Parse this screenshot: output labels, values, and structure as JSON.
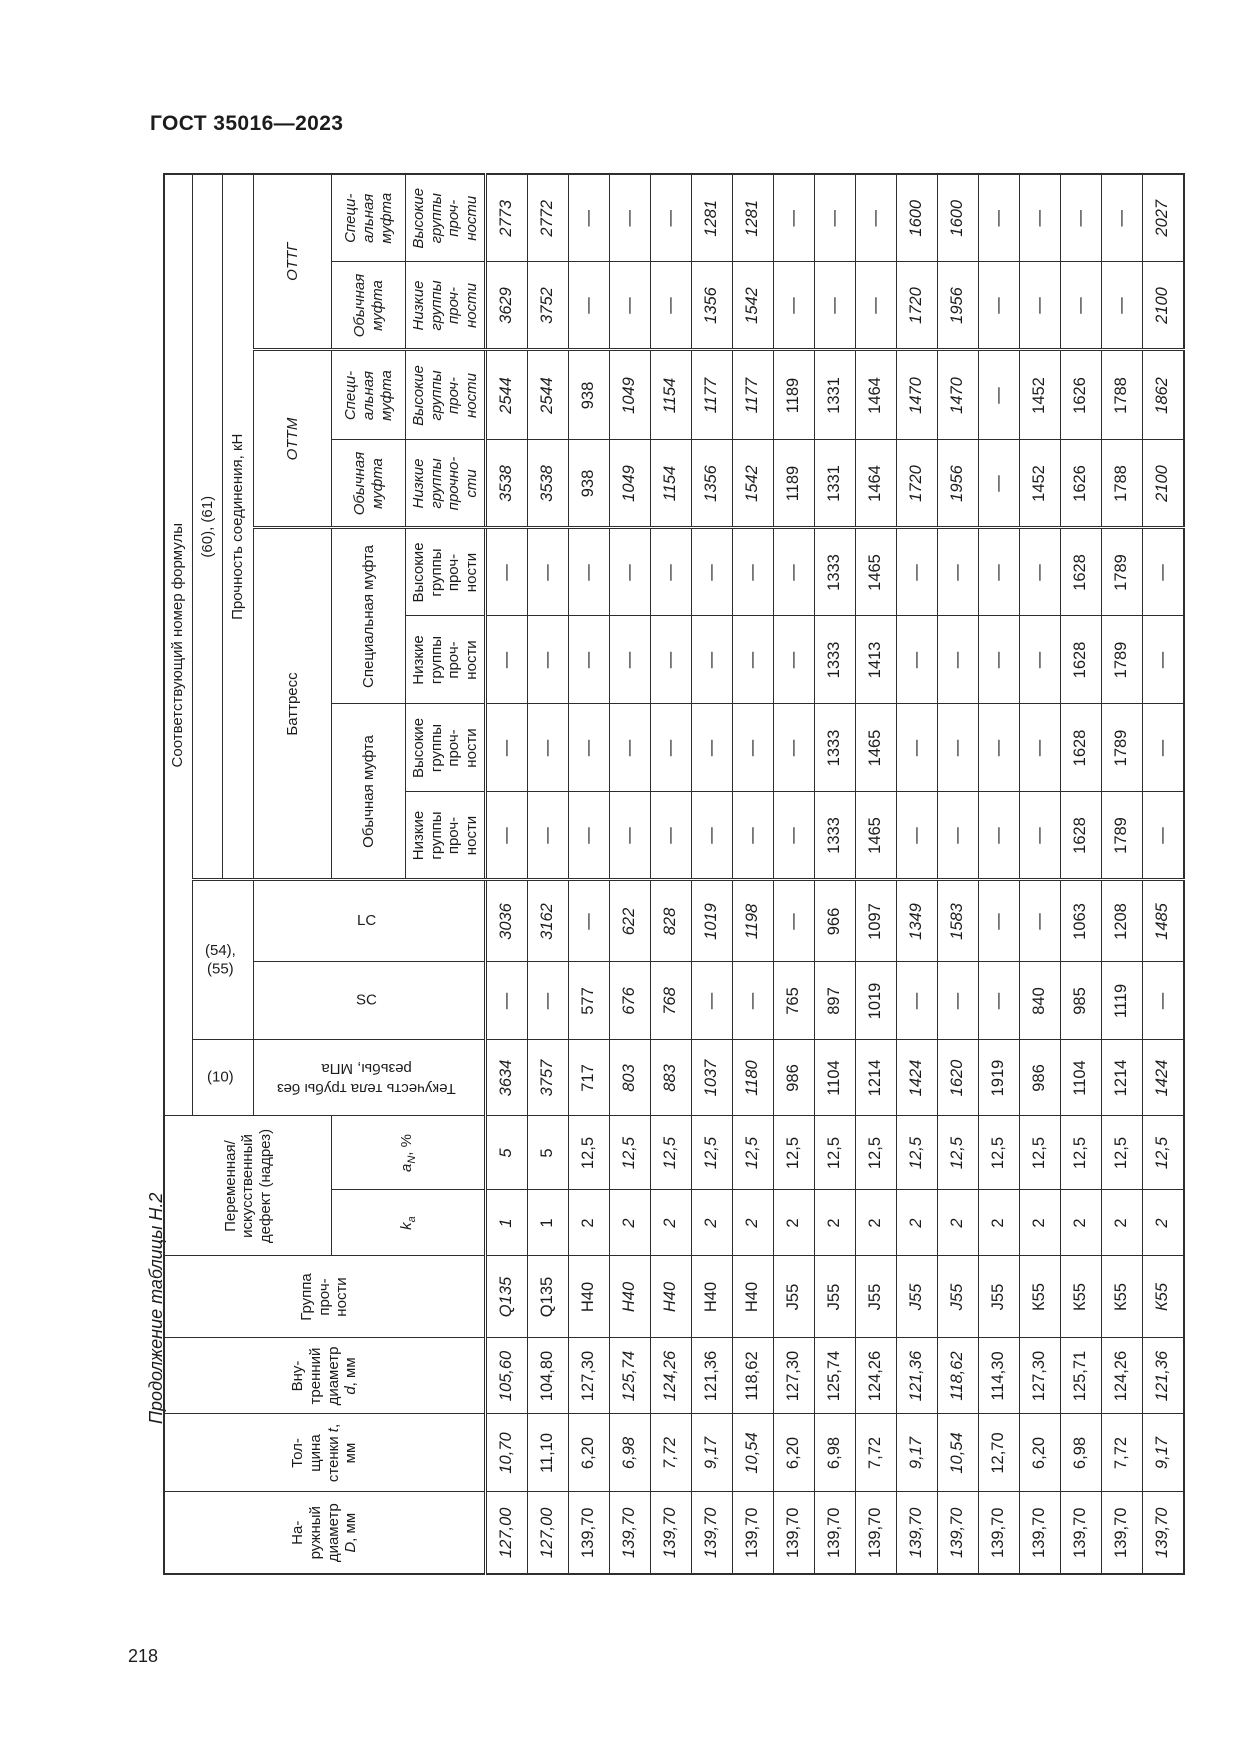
{
  "page": {
    "doc_header": "ГОСТ 35016—2023",
    "table_caption": "Продолжение таблицы Н.2",
    "page_number": "218"
  },
  "table": {
    "corr_formula": "Соответствующий номер формулы",
    "formula_yield": "(10)",
    "formula_sclc": "(54), (55)",
    "formula_conn": "(60), (61)",
    "conn_strength": "Прочность соединения, кН",
    "cols": {
      "outer_pre": "На-\nружный\nдиаметр\n",
      "outer_sym": "D",
      "outer_post": ", мм",
      "wall_pre": "Тол-\nщина\nстенки ",
      "wall_sym": "t",
      "wall_post": ",\nмм",
      "inner_pre": "Вну-\nтренний\nдиаметр\n",
      "inner_sym": "d",
      "inner_post": ", мм",
      "grade": "Группа\nпроч-\nности",
      "defect": "Переменная/\nискусственный\nдефект (надрез)",
      "ka_sym": "k",
      "ka_sub": "a",
      "an_sym": "a",
      "an_sub": "N",
      "an_post": ", %",
      "yield_body": "Текучесть тела трубы без\nрезьбы, МПа",
      "sc": "SC",
      "lc": "LC"
    },
    "groups": {
      "buttress": "Баттресс",
      "ottm": "ОТТМ",
      "ottg": "ОТТГ",
      "regular_coupling": "Обычная муфта",
      "special_coupling": "Специальная муфта",
      "regular_coupling_narrow": "Обычная\nмуфта",
      "special_coupling_narrow": "Специ-\nальная\nмуфта",
      "low_groups": "Низкие\nгруппы\nпроч-\nности",
      "high_groups": "Высокие\nгруппы\nпроч-\nности",
      "low_groups_ottm": "Низкие\nгруппы\nпрочно-\nсти"
    },
    "rows": [
      {
        "v": [
          "127,00",
          "10,70",
          "105,60",
          "Q135",
          "1",
          "5",
          "3634",
          "—",
          "3036",
          "—",
          "—",
          "—",
          "—",
          "3538",
          "2544",
          "3629",
          "2773"
        ],
        "s": [
          "i",
          "i",
          "i",
          "i",
          "i",
          "bi",
          "bi",
          "n",
          "bi",
          "n",
          "n",
          "n",
          "n",
          "i",
          "i",
          "i",
          "i"
        ]
      },
      {
        "v": [
          "127,00",
          "11,10",
          "104,80",
          "Q135",
          "1",
          "5",
          "3757",
          "—",
          "3162",
          "—",
          "—",
          "—",
          "—",
          "3538",
          "2544",
          "3752",
          "2772"
        ],
        "s": [
          "i",
          "n",
          "n",
          "n",
          "n",
          "n",
          "i",
          "n",
          "i",
          "n",
          "n",
          "n",
          "n",
          "i",
          "i",
          "i",
          "i"
        ]
      },
      {
        "v": [
          "139,70",
          "6,20",
          "127,30",
          "Н40",
          "2",
          "12,5",
          "717",
          "577",
          "—",
          "—",
          "—",
          "—",
          "—",
          "938",
          "938",
          "—",
          "—"
        ],
        "s": [
          "n",
          "n",
          "n",
          "n",
          "n",
          "n",
          "n",
          "n",
          "n",
          "n",
          "n",
          "n",
          "n",
          "n",
          "n",
          "n",
          "n"
        ]
      },
      {
        "v": [
          "139,70",
          "6,98",
          "125,74",
          "Н40",
          "2",
          "12,5",
          "803",
          "676",
          "622",
          "—",
          "—",
          "—",
          "—",
          "1049",
          "1049",
          "—",
          "—"
        ],
        "s": [
          "i",
          "i",
          "i",
          "i",
          "i",
          "i",
          "i",
          "bi",
          "i",
          "n",
          "n",
          "n",
          "n",
          "i",
          "i",
          "n",
          "n"
        ]
      },
      {
        "v": [
          "139,70",
          "7,72",
          "124,26",
          "Н40",
          "2",
          "12,5",
          "883",
          "768",
          "828",
          "—",
          "—",
          "—",
          "—",
          "1154",
          "1154",
          "—",
          "—"
        ],
        "s": [
          "i",
          "i",
          "i",
          "i",
          "i",
          "i",
          "i",
          "bi",
          "i",
          "n",
          "n",
          "n",
          "n",
          "i",
          "i",
          "n",
          "n"
        ]
      },
      {
        "v": [
          "139,70",
          "9,17",
          "121,36",
          "Н40",
          "2",
          "12,5",
          "1037",
          "—",
          "1019",
          "—",
          "—",
          "—",
          "—",
          "1356",
          "1177",
          "1356",
          "1281"
        ],
        "s": [
          "i",
          "i",
          "n",
          "n",
          "i",
          "i",
          "i",
          "n",
          "i",
          "n",
          "n",
          "n",
          "n",
          "i",
          "i",
          "i",
          "i"
        ]
      },
      {
        "v": [
          "139,70",
          "10,54",
          "118,62",
          "Н40",
          "2",
          "12,5",
          "1180",
          "—",
          "1198",
          "—",
          "—",
          "—",
          "—",
          "1542",
          "1177",
          "1542",
          "1281"
        ],
        "s": [
          "n",
          "i",
          "n",
          "n",
          "i",
          "i",
          "i",
          "n",
          "i",
          "n",
          "n",
          "n",
          "n",
          "i",
          "i",
          "i",
          "i"
        ]
      },
      {
        "v": [
          "139,70",
          "6,20",
          "127,30",
          "J55",
          "2",
          "12,5",
          "986",
          "765",
          "—",
          "—",
          "—",
          "—",
          "—",
          "1189",
          "1189",
          "—",
          "—"
        ],
        "s": [
          "n",
          "n",
          "n",
          "n",
          "n",
          "n",
          "n",
          "n",
          "n",
          "n",
          "n",
          "n",
          "n",
          "n",
          "n",
          "n",
          "n"
        ]
      },
      {
        "v": [
          "139,70",
          "6,98",
          "125,74",
          "J55",
          "2",
          "12,5",
          "1104",
          "897",
          "966",
          "1333",
          "1333",
          "1333",
          "1333",
          "1331",
          "1331",
          "—",
          "—"
        ],
        "s": [
          "n",
          "n",
          "n",
          "n",
          "n",
          "n",
          "n",
          "n",
          "n",
          "n",
          "n",
          "n",
          "n",
          "n",
          "n",
          "n",
          "n"
        ]
      },
      {
        "v": [
          "139,70",
          "7,72",
          "124,26",
          "J55",
          "2",
          "12,5",
          "1214",
          "1019",
          "1097",
          "1465",
          "1465",
          "1413",
          "1465",
          "1464",
          "1464",
          "—",
          "—"
        ],
        "s": [
          "n",
          "n",
          "n",
          "n",
          "n",
          "n",
          "n",
          "n",
          "n",
          "n",
          "n",
          "n",
          "n",
          "n",
          "n",
          "n",
          "n"
        ]
      },
      {
        "v": [
          "139,70",
          "9,17",
          "121,36",
          "J55",
          "2",
          "12,5",
          "1424",
          "—",
          "1349",
          "—",
          "—",
          "—",
          "—",
          "1720",
          "1470",
          "1720",
          "1600"
        ],
        "s": [
          "i",
          "i",
          "i",
          "i",
          "i",
          "i",
          "i",
          "n",
          "i",
          "n",
          "n",
          "n",
          "n",
          "i",
          "i",
          "i",
          "i"
        ]
      },
      {
        "v": [
          "139,70",
          "10,54",
          "118,62",
          "J55",
          "2",
          "12,5",
          "1620",
          "—",
          "1583",
          "—",
          "—",
          "—",
          "—",
          "1956",
          "1470",
          "1956",
          "1600"
        ],
        "s": [
          "i",
          "i",
          "i",
          "i",
          "i",
          "i",
          "i",
          "n",
          "i",
          "n",
          "n",
          "n",
          "n",
          "i",
          "i",
          "i",
          "i"
        ]
      },
      {
        "v": [
          "139,70",
          "12,70",
          "114,30",
          "J55",
          "2",
          "12,5",
          "1919",
          "—",
          "—",
          "—",
          "—",
          "—",
          "—",
          "—",
          "—",
          "—",
          "—"
        ],
        "s": [
          "n",
          "n",
          "n",
          "n",
          "n",
          "n",
          "n",
          "n",
          "n",
          "n",
          "n",
          "n",
          "n",
          "n",
          "n",
          "n",
          "n"
        ]
      },
      {
        "v": [
          "139,70",
          "6,20",
          "127,30",
          "К55",
          "2",
          "12,5",
          "986",
          "840",
          "—",
          "—",
          "—",
          "—",
          "—",
          "1452",
          "1452",
          "—",
          "—"
        ],
        "s": [
          "n",
          "n",
          "n",
          "n",
          "n",
          "n",
          "n",
          "n",
          "n",
          "n",
          "n",
          "n",
          "n",
          "n",
          "n",
          "n",
          "n"
        ]
      },
      {
        "v": [
          "139,70",
          "6,98",
          "125,71",
          "К55",
          "2",
          "12,5",
          "1104",
          "985",
          "1063",
          "1628",
          "1628",
          "1628",
          "1628",
          "1626",
          "1626",
          "—",
          "—"
        ],
        "s": [
          "n",
          "n",
          "n",
          "n",
          "n",
          "n",
          "n",
          "n",
          "n",
          "n",
          "n",
          "n",
          "n",
          "n",
          "n",
          "n",
          "n"
        ]
      },
      {
        "v": [
          "139,70",
          "7,72",
          "124,26",
          "К55",
          "2",
          "12,5",
          "1214",
          "1119",
          "1208",
          "1789",
          "1789",
          "1789",
          "1789",
          "1788",
          "1788",
          "—",
          "—"
        ],
        "s": [
          "n",
          "n",
          "n",
          "n",
          "n",
          "n",
          "n",
          "n",
          "n",
          "n",
          "n",
          "n",
          "n",
          "n",
          "n",
          "n",
          "n"
        ]
      },
      {
        "v": [
          "139,70",
          "9,17",
          "121,36",
          "К55",
          "2",
          "12,5",
          "1424",
          "—",
          "1485",
          "—",
          "—",
          "—",
          "—",
          "2100",
          "1862",
          "2100",
          "2027"
        ],
        "s": [
          "i",
          "i",
          "i",
          "i",
          "i",
          "i",
          "i",
          "n",
          "i",
          "n",
          "n",
          "n",
          "n",
          "i",
          "i",
          "i",
          "i"
        ]
      }
    ]
  }
}
